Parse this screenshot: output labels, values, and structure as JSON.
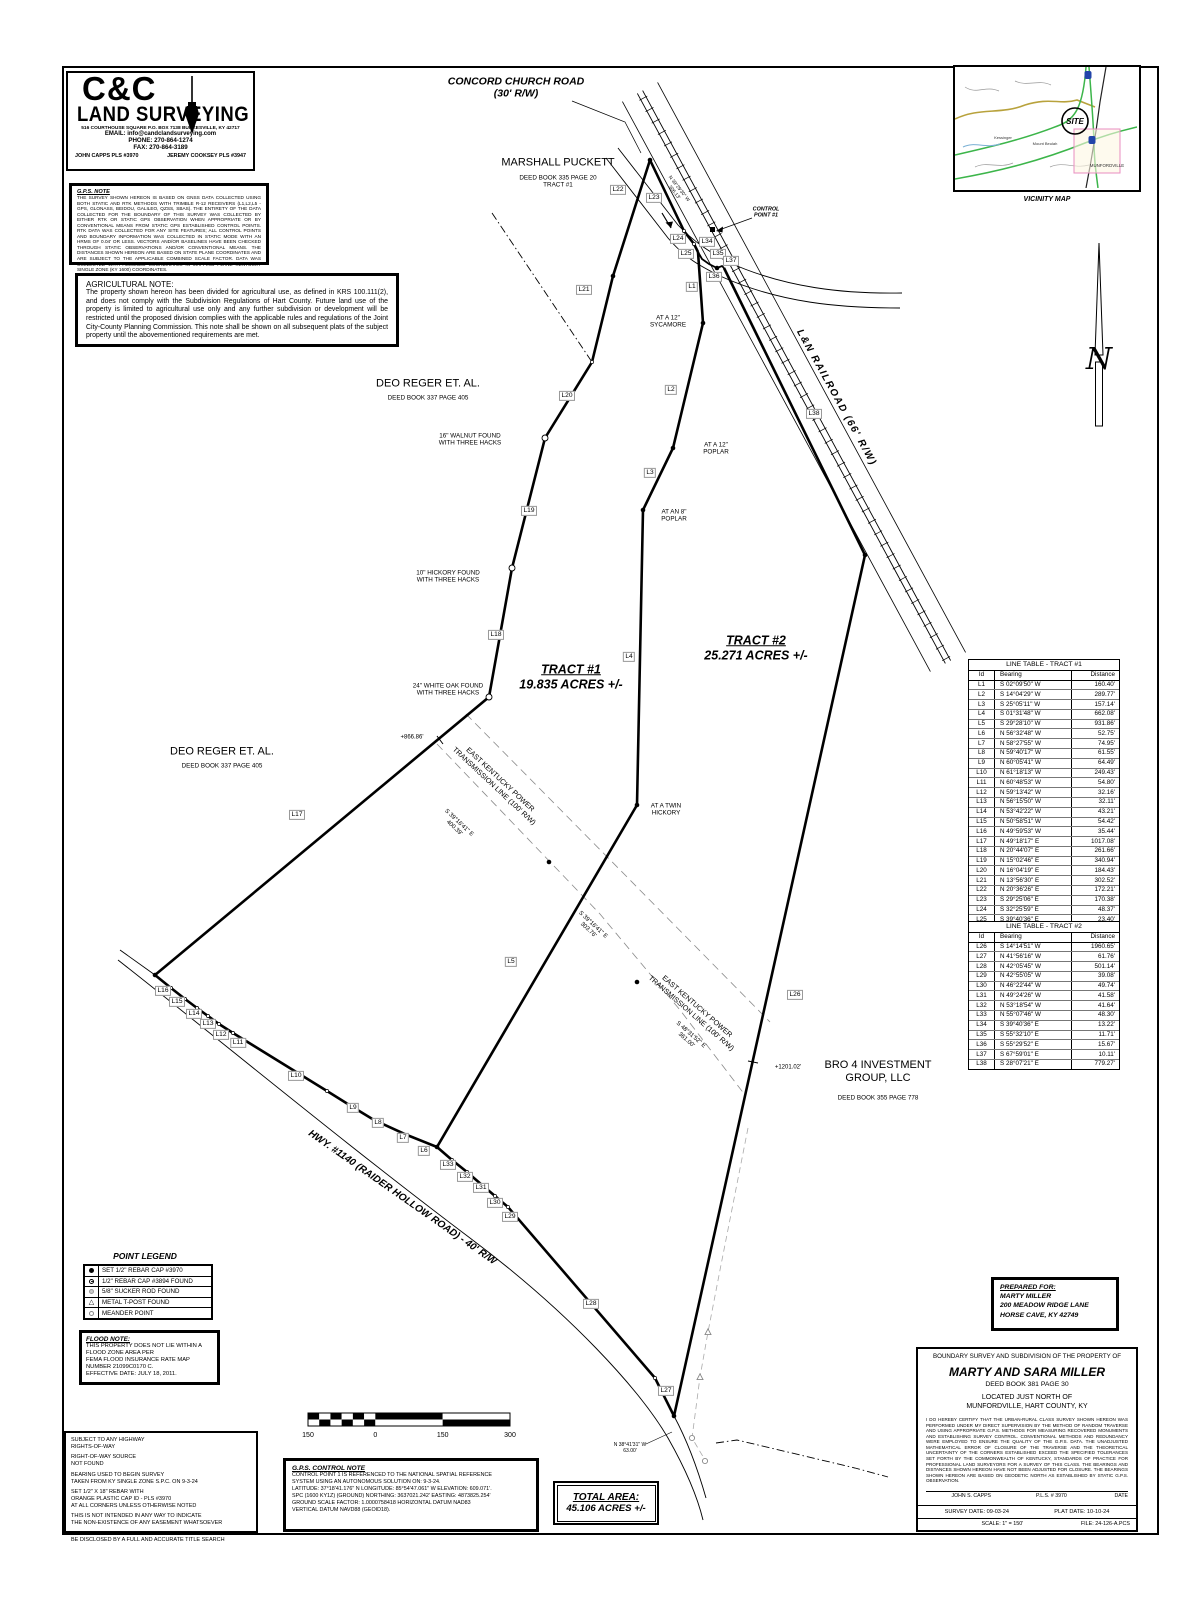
{
  "logo": {
    "name1": "C&C",
    "name2": "LAND SURVEYING",
    "address": "516 COURTHOUSE SQUARE  P.O. BOX 7138        BURKESVILLE, KY 42717",
    "email": "EMAIL: info@candclandsurveying.com",
    "phone": "PHONE: 270-864-1274",
    "fax": "FAX: 270-864-3189",
    "surveyor1": "JOHN CAPPS PLS #3970",
    "surveyor2": "JEREMY COOKSEY PLS #3947"
  },
  "gps_note": {
    "title": "G.P.S. NOTE",
    "body": "THE SURVEY SHOWN HEREON IS BASED ON GNSS DATA COLLECTED USING BOTH STATIC AND RTK METHODS WITH TRIMBLE R-12 RECEIVERS (L1,L2,L5 - GPS, GLONASS, BEIDOU, GALILEO, QZSS, SBAS). THE ENTIRETY OF THE DATA COLLECTED FOR THE BOUNDARY OF THIS SURVEY WAS COLLECTED BY EITHER RTK OR STATIC GPS OBSERVATION WHEN APPROPRIATE OR BY CONVENTIONAL MEANS FROM STATIC GPS ESTABLISHED CONTROL POINTS. RTK DATA WAS COLLECTED FOR ANY SITE FEATURES; ALL CONTROL POINTS AND BOUNDARY INFORMATION WAS COLLECTED IN STATIC MODE WITH AN HRMS OF 0.04' OR LESS. VECTORS AND/OR BASELINES HAVE BEEN CHECKED THROUGH STATIC OBSERVATIONS AND/OR CONVENTIONAL MEANS. THE DISTANCES SHOWN HEREON ARE BASED ON STATE PLANE COORDINATES AND ARE SUBJECT TO THE APPLICABLE COMBINED SCALE FACTOR. DATA WAS COLLECTED WITH ASSUMED COORDINATES IN MAPPING PLANE KENTUCKY SINGLE ZONE (KY 1600) COORDINATES."
  },
  "ag_note": {
    "title": "AGRICULTURAL NOTE:",
    "body": "The property shown hereon has been divided for agricultural use,  as defined in KRS 100.111(2), and does not comply with the Subdivision Regulations of Hart County.  Future land use of the property is limited to agricultural use only and any further subdivision or development will be restricted until the proposed division complies with the applicable rules and regulations of the Joint City-County Planning Commission. This note shall be shown on all subsequent plats of the subject property until the abovementioned requirements are met."
  },
  "vicinity": {
    "caption": "VICINITY MAP",
    "site_label": "SITE",
    "towns": [
      "Kessinger",
      "Mount Beulah",
      "MUNFORDVILLE"
    ]
  },
  "compass": {
    "n": "N"
  },
  "line_tables": [
    {
      "title": "LINE TABLE - TRACT #1",
      "headers": [
        "Id",
        "Bearing",
        "Distance"
      ],
      "rows": [
        [
          "L1",
          "S 02°09'50\" W",
          "160.40'"
        ],
        [
          "L2",
          "S 14°04'29\" W",
          "289.77'"
        ],
        [
          "L3",
          "S 25°05'11\" W",
          "157.14'"
        ],
        [
          "L4",
          "S 01°31'48\" W",
          "662.08'"
        ],
        [
          "L5",
          "S 29°28'10\" W",
          "931.86'"
        ],
        [
          "L6",
          "N 56°32'48\" W",
          "52.75'"
        ],
        [
          "L7",
          "N 58°27'55\" W",
          "74.95'"
        ],
        [
          "L8",
          "N 59°40'17\" W",
          "61.55'"
        ],
        [
          "L9",
          "N 60°05'41\" W",
          "64.49'"
        ],
        [
          "L10",
          "N 61°18'13\" W",
          "249.43'"
        ],
        [
          "L11",
          "N 60°48'53\" W",
          "54.80'"
        ],
        [
          "L12",
          "N 59°13'42\" W",
          "32.16'"
        ],
        [
          "L13",
          "N 56°15'50\" W",
          "32.11'"
        ],
        [
          "L14",
          "N 53°42'22\" W",
          "43.21'"
        ],
        [
          "L15",
          "N 50°58'51\" W",
          "54.42'"
        ],
        [
          "L16",
          "N 49°59'53\" W",
          "35.44'"
        ],
        [
          "L17",
          "N 49°18'17\" E",
          "1017.08'"
        ],
        [
          "L18",
          "N 20°44'07\" E",
          "261.66'"
        ],
        [
          "L19",
          "N 15°02'46\" E",
          "340.94'"
        ],
        [
          "L20",
          "N 16°04'19\" E",
          "184.43'"
        ],
        [
          "L21",
          "N 13°56'30\" E",
          "302.52'"
        ],
        [
          "L22",
          "N 20°36'26\" E",
          "172.21'"
        ],
        [
          "L23",
          "S 29°25'06\" E",
          "170.38'"
        ],
        [
          "L24",
          "S 32°25'59\" E",
          "48.37'"
        ],
        [
          "L25",
          "S 39°40'36\" E",
          "23.40'"
        ]
      ]
    },
    {
      "title": "LINE TABLE - TRACT #2",
      "headers": [
        "Id",
        "Bearing",
        "Distance"
      ],
      "rows": [
        [
          "L26",
          "S 14°14'51\" W",
          "1960.65'"
        ],
        [
          "L27",
          "N 41°56'16\" W",
          "61.76'"
        ],
        [
          "L28",
          "N 42°05'45\" W",
          "501.14'"
        ],
        [
          "L29",
          "N 42°55'05\" W",
          "39.08'"
        ],
        [
          "L30",
          "N 46°22'44\" W",
          "49.74'"
        ],
        [
          "L31",
          "N 49°24'26\" W",
          "41.58'"
        ],
        [
          "L32",
          "N 53°18'54\" W",
          "41.64'"
        ],
        [
          "L33",
          "N 55°07'46\" W",
          "48.30'"
        ],
        [
          "L34",
          "S 39°40'36\" E",
          "13.22'"
        ],
        [
          "L35",
          "S 55°32'10\" E",
          "11.71'"
        ],
        [
          "L36",
          "S 55°29'52\" E",
          "15.67'"
        ],
        [
          "L37",
          "S 67°59'01\" E",
          "10.11'"
        ],
        [
          "L38",
          "S 28°07'21\" E",
          "779.27'"
        ]
      ]
    }
  ],
  "point_legend": {
    "title": "POINT LEGEND",
    "items": [
      {
        "symbol": "set-rebar",
        "label": "SET 1/2\" REBAR CAP #3970"
      },
      {
        "symbol": "found-rebar",
        "label": "1/2\" REBAR CAP #3894 FOUND"
      },
      {
        "symbol": "sucker-rod",
        "label": "5/8\" SUCKER ROD FOUND"
      },
      {
        "symbol": "t-post",
        "label": "METAL T-POST FOUND"
      },
      {
        "symbol": "meander",
        "label": "MEANDER POINT"
      }
    ]
  },
  "flood_note": {
    "title": "FLOOD NOTE:",
    "lines": [
      "THIS PROPERTY DOES NOT LIE WITHIN A",
      "FLOOD ZONE AREA PER",
      "FEMA FLOOD INSURANCE RATE MAP",
      "NUMBER 21099C0170 C.",
      "EFFECTIVE DATE: JULY 18, 2011."
    ]
  },
  "notes": [
    [
      "SUBJECT TO ANY HIGHWAY",
      "RIGHTS-OF-WAY"
    ],
    [
      "RIGHT-OF-WAY SOURCE",
      "NOT FOUND"
    ],
    [
      "BEARING USED TO BEGIN SURVEY",
      "TAKEN FROM KY SINGLE ZONE S.P.C. ON 9-3-24"
    ],
    [
      "SET 1/2\" X 18\" REBAR WITH",
      "ORANGE PLASTIC CAP ID - PLS #3970",
      "AT ALL CORNERS UNLESS OTHERWISE NOTED"
    ],
    [
      "THIS IS NOT INTENDED IN ANY WAY TO INDICATE",
      "THE NON-EXISTENCE OF ANY EASEMENT WHATSOEVER"
    ],
    [
      "THIS SURVEY IS SUBJECT TO ANY AND ALL FACTS THAT MAY",
      "BE DISCLOSED BY A FULL AND ACCURATE TITLE SEARCH"
    ]
  ],
  "scale_bar": {
    "labels": [
      "150",
      "0",
      "150",
      "300"
    ]
  },
  "gps_control": {
    "title": "G.P.S. CONTROL NOTE",
    "lines": [
      "CONTROL POINT 1 IS REFERENCED TO THE NATIONAL SPATIAL REFERENCE",
      "SYSTEM USING AN AUTONOMOUS SOLUTION ON: 9-3-24.",
      "LATITUDE: 37°18'41.176\" N  LONGITUDE: 85°54'47.061\" W   ELEVATION: 609.071'.",
      "SPC (1600 KY1Z) (GROUND) NORTHING: 3637021.242'   EASTING: 4873825.254'",
      "GROUND SCALE FACTOR: 1.0000758418   HORIZONTAL DATUM NAD83",
      "VERTICAL DATUM NAVD88 (GEOID18)."
    ]
  },
  "total_area": {
    "title": "TOTAL AREA:",
    "value": "45.106 ACRES +/-"
  },
  "prepared_for": {
    "title": "PREPARED FOR:",
    "name": "MARTY MILLER",
    "address1": "200 MEADOW RIDGE LANE",
    "address2": "HORSE CAVE, KY 42749"
  },
  "title_block": {
    "header": "BOUNDARY SURVEY AND SUBDIVISION OF THE PROPERTY OF",
    "owner": "MARTY AND SARA MILLER",
    "deed": "DEED BOOK 381 PAGE 30",
    "located1": "LOCATED JUST NORTH OF",
    "located2": "MUNFORDVILLE, HART COUNTY, KY",
    "cert": "I DO HEREBY CERTIFY THAT THE URBAN-RURAL CLASS SURVEY SHOWN HEREON WAS PERFORMED UNDER MY DIRECT SUPERVISION BY THE METHOD OF RANDOM TRAVERSE AND USING APPROPRIATE G.P.S. METHODS FOR MEASURING RECOVERED MONUMENTS AND ESTABLISHING SURVEY CONTROL.  CONVENTIONAL METHODS AND REDUNDANCY WERE EMPLOYED TO ENSURE THE QUALITY OF THE G.P.S. DATA.  THE UNADJUSTED MATHEMATICAL ERROR OF CLOSURE OF THE TRAVERSE AND THE THEORETICAL UNCERTAINTY OF THE CORNERS ESTABLISHED EXCEED THE SPECIFIED TOLERANCES SET FORTH BY THE COMMONWEALTH OF KENTUCKY, STANDARDS OF PRACTICE FOR PROFESSIONAL LAND SURVEYORS FOR A SURVEY OF THIS CLASS.  THE BEARINGS AND DISTANCES SHOWN HEREON HAVE NOT BEEN ADJUSTED FOR CLOSURE.  THE BEARINGS SHOWN HEREON ARE BASED ON GEODETIC NORTH AS ESTABLISHED BY STATIC G.P.S. OBSERVATION.",
    "sig_name": "JOHN  S.  CAPPS",
    "sig_pls": "P.L.S.  #  3970",
    "sig_date": "DATE",
    "survey_date": "SURVEY DATE:  09-03-24",
    "plat_date": "PLAT DATE:  10-10-24",
    "scale": "SCALE:  1\" = 150'",
    "file": "FILE: 24-126-A.PCS"
  },
  "map_labels": [
    {
      "name": "road-name-concord",
      "lines": [
        "CONCORD CHURCH ROAD",
        "(30' R/W)"
      ]
    },
    {
      "name": "owner-marshall-puckett",
      "lines": [
        "MARSHALL PUCKETT"
      ]
    },
    {
      "name": "owner-marshall-puckett-deed",
      "lines": [
        "DEED BOOK 335 PAGE 20",
        "TRACT #1"
      ]
    },
    {
      "name": "control-point-label",
      "lines": [
        "CONTROL",
        "POINT #1"
      ]
    },
    {
      "name": "railroad-name",
      "lines": [
        "L&N RAILROAD (66' R/W)"
      ]
    },
    {
      "name": "road-bearing-top",
      "lines": [
        "N 39°29'30\" W",
        "306.13'"
      ]
    },
    {
      "name": "owner-deo-reger-1",
      "lines": [
        "DEO REGER ET. AL."
      ]
    },
    {
      "name": "owner-deo-reger-1-deed",
      "lines": [
        "DEED BOOK 337 PAGE 405"
      ]
    },
    {
      "name": "owner-deo-reger-2",
      "lines": [
        "DEO REGER ET. AL."
      ]
    },
    {
      "name": "owner-deo-reger-2-deed",
      "lines": [
        "DEED BOOK 337 PAGE 405"
      ]
    },
    {
      "name": "monument-walnut",
      "lines": [
        "16\" WALNUT FOUND",
        "WITH THREE HACKS"
      ]
    },
    {
      "name": "monument-hickory-10",
      "lines": [
        "10\" HICKORY FOUND",
        "WITH THREE HACKS"
      ]
    },
    {
      "name": "monument-white-oak",
      "lines": [
        "24\" WHITE OAK FOUND",
        "WITH THREE HACKS"
      ]
    },
    {
      "name": "distance-tick-866",
      "lines": [
        "+866.86'"
      ]
    },
    {
      "name": "monument-sycamore",
      "lines": [
        "AT A 12\"",
        "SYCAMORE"
      ]
    },
    {
      "name": "monument-poplar-12",
      "lines": [
        "AT A 12\"",
        "POPLAR"
      ]
    },
    {
      "name": "monument-poplar-8",
      "lines": [
        "AT AN 8\"",
        "POPLAR"
      ]
    },
    {
      "name": "monument-twin-hickory",
      "lines": [
        "AT A TWIN",
        "HICKORY"
      ]
    },
    {
      "name": "tract1-label",
      "lines": [
        "TRACT #1",
        "19.835 ACRES +/-"
      ]
    },
    {
      "name": "tract2-label",
      "lines": [
        "TRACT #2",
        "25.271 ACRES +/-"
      ]
    },
    {
      "name": "transmission-line-1",
      "lines": [
        "EAST KENTUCKY POWER",
        "TRANSMISSION LINE (100' R/W)"
      ]
    },
    {
      "name": "transmission-bearing-1",
      "lines": [
        "S 39°16'41\" E",
        "400.39'"
      ]
    },
    {
      "name": "transmission-bearing-2",
      "lines": [
        "S 39°16'41\" E",
        "303.76'"
      ]
    },
    {
      "name": "transmission-line-2",
      "lines": [
        "EAST KENTUCKY POWER",
        "TRANSMISSION LINE (100' R/W)"
      ]
    },
    {
      "name": "transmission-bearing-3",
      "lines": [
        "S 48°31'52\" E",
        "361.00'"
      ]
    },
    {
      "name": "distance-tick-1201",
      "lines": [
        "+1201.02'"
      ]
    },
    {
      "name": "owner-bro4",
      "lines": [
        "BRO 4 INVESTMENT",
        "GROUP, LLC"
      ]
    },
    {
      "name": "owner-bro4-deed",
      "lines": [
        "DEED BOOK 355 PAGE 778"
      ]
    },
    {
      "name": "road-name-hwy1140",
      "lines": [
        "HWY. #1140 (RAIDER HOLLOW ROAD) - 40' R/W"
      ]
    },
    {
      "name": "road-bearing-bottom",
      "lines": [
        "N 38°41'31\" W",
        "63.00'"
      ]
    }
  ]
}
